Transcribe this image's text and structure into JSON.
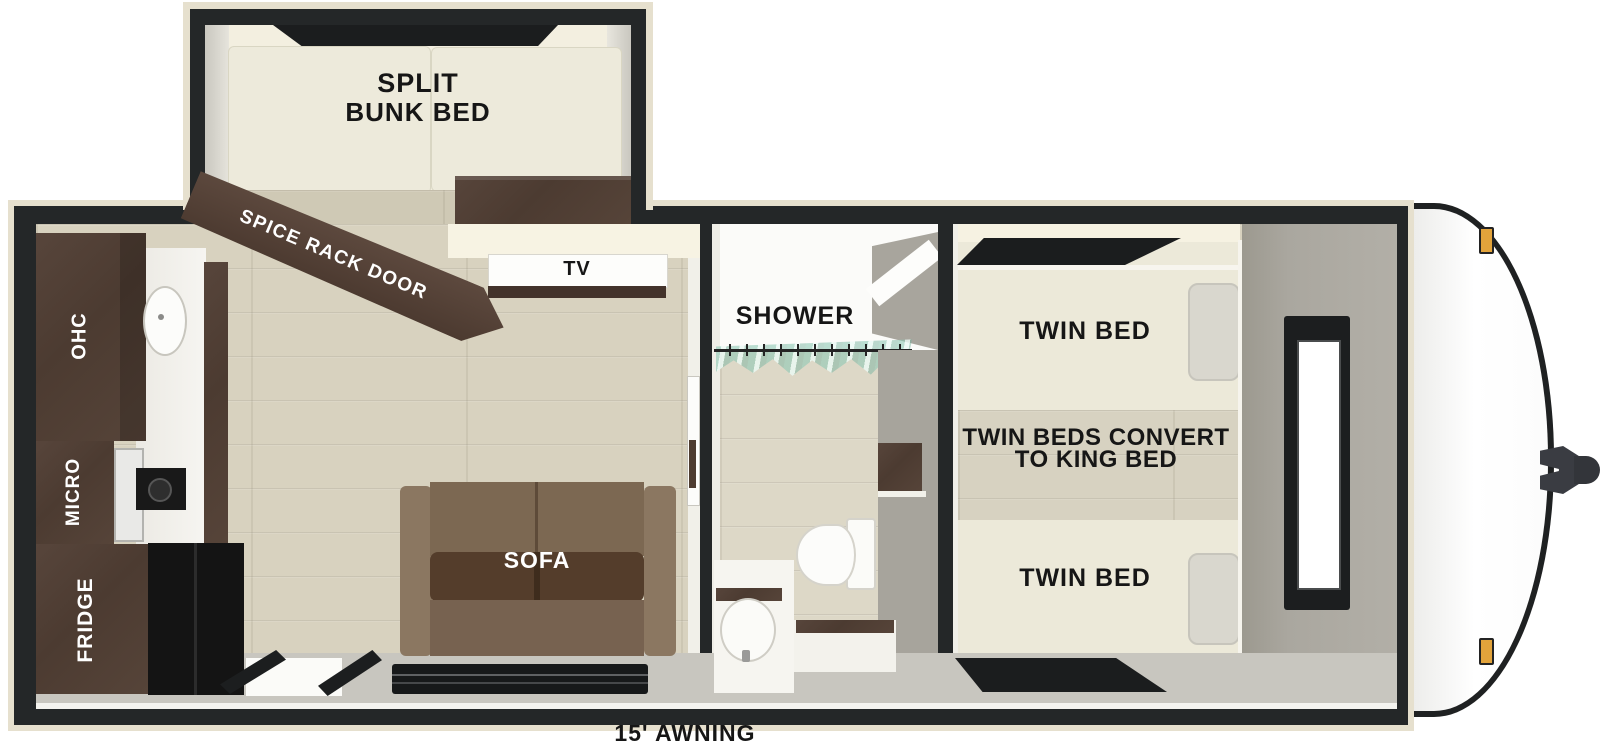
{
  "title": "Travel Trailer Floorplan",
  "labels": {
    "bunk_room": {
      "line1": "SPLIT",
      "line2": "BUNK BED"
    },
    "spice_rack_door": "SPICE RACK DOOR",
    "tv": "TV",
    "kitchen": {
      "ohc": "OHC",
      "micro": "MICRO",
      "fridge": "FRIDGE"
    },
    "sofa": "SOFA",
    "bathroom": {
      "shower": "SHOWER"
    },
    "bedroom": {
      "twin_bed_top": "TWIN BED",
      "convert_line1": "TWIN BEDS CONVERT",
      "convert_line2": "TO KING BED",
      "twin_bed_bottom": "TWIN BED"
    },
    "awning": "15' AWNING"
  },
  "colors": {
    "wall_black": "#242728",
    "exterior_trim_cream": "#e6e0ce",
    "floor_wood": "#d8d2bf",
    "cabinet_brown": "#4f3e35",
    "sofa_brown": "#7c6852",
    "mattress_cream": "#ece9d9",
    "wall_gray": "#a9a69e",
    "marker_light_amber": "#e2a33b",
    "shower_curtain_teal": "#b9ddd3",
    "label_black": "#161616",
    "label_white": "#ffffff"
  }
}
